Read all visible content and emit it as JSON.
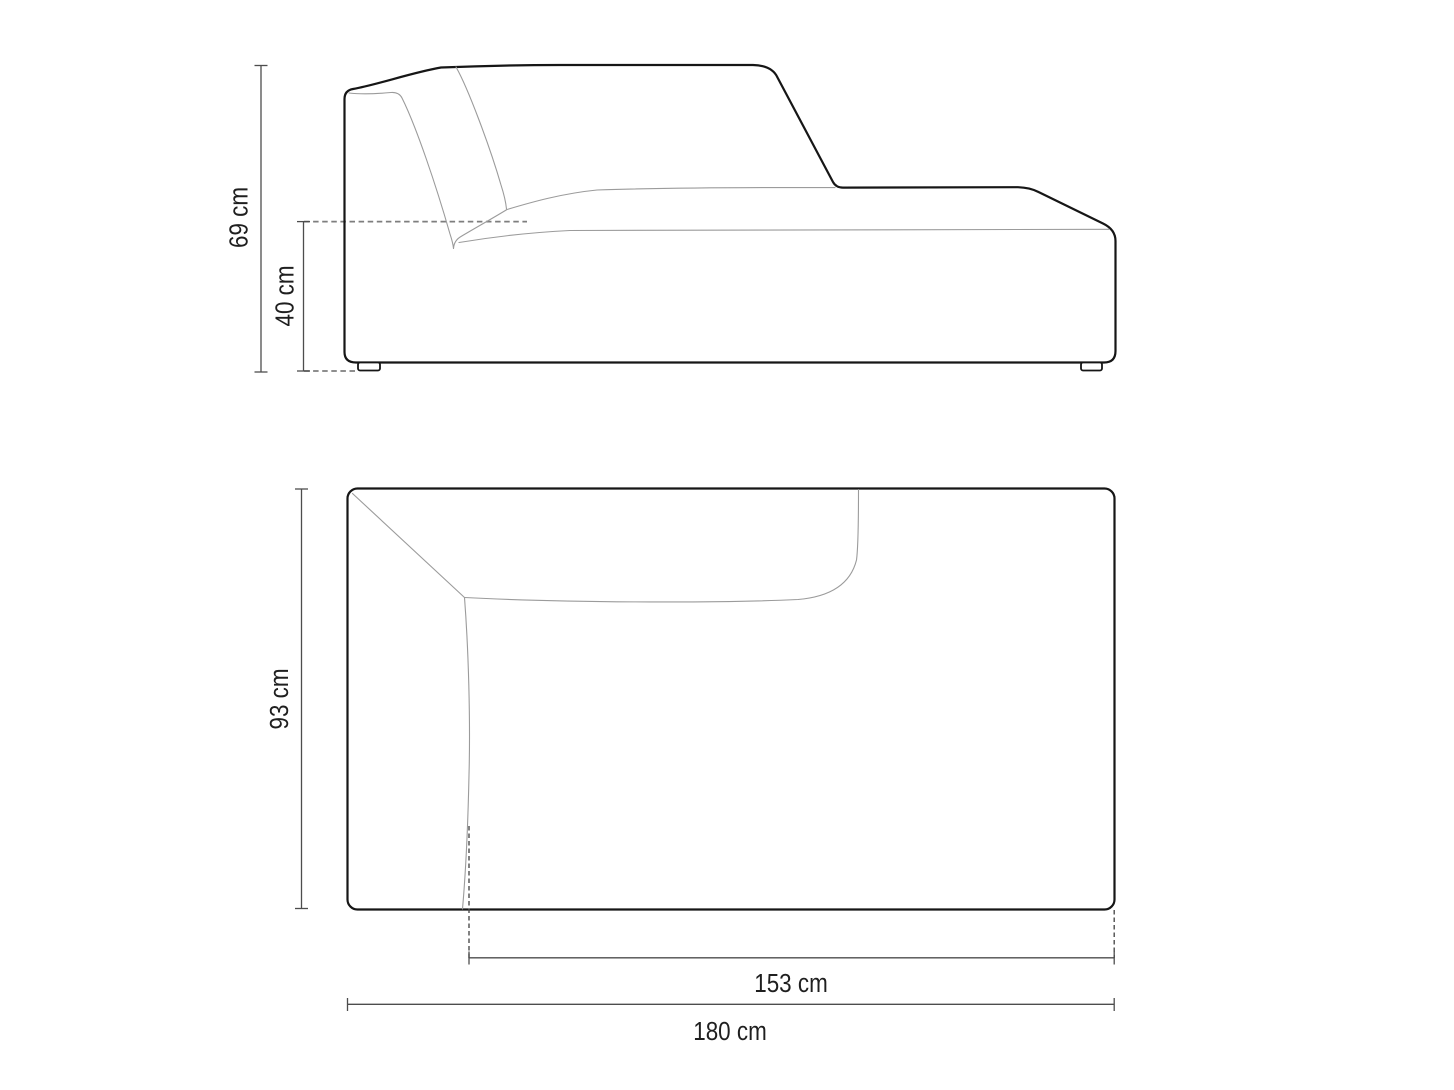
{
  "drawing": {
    "type": "furniture-dimension-diagram",
    "views": {
      "side_view": "sofa chaise module side elevation",
      "top_view": "sofa chaise module plan view"
    },
    "dimensions": {
      "height": "69 cm",
      "seat_height": "40 cm",
      "depth": "93 cm",
      "chaise_length": "153 cm",
      "width": "180 cm"
    },
    "colors": {
      "background": "#ffffff",
      "outline": "#161616",
      "seam_lines": "#9b9b9b",
      "dimension_lines": "#4d4d4d",
      "dashed_lines": "#7e7e7e",
      "label_text": "#1f1f1f"
    }
  }
}
